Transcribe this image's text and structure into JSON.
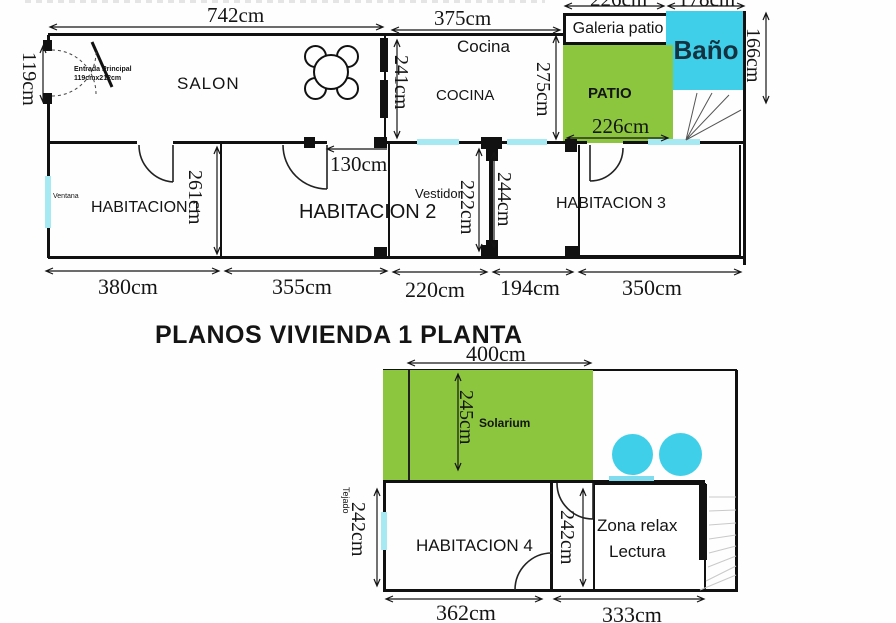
{
  "title": "PLANOS VIVIENDA 1 PLANTA",
  "colors": {
    "green": "#8CC63E",
    "cyan": "#3FCFE9",
    "window": "#A6E9F2",
    "wall": "#111111"
  },
  "upper": {
    "rooms": {
      "salon": "SALON",
      "cocina_small": "Cocina",
      "cocina": "COCINA",
      "galeria": "Galeria patio",
      "bano": "Baño",
      "patio": "PATIO",
      "hab1": "HABITACION 1",
      "hab2": "HABITACION 2",
      "hab3": "HABITACION 3",
      "vestidor": "Vestidor"
    },
    "notes": {
      "entrada1": "Entrada Principal",
      "entrada2": "119cmx212cm",
      "ventana": "Ventana"
    },
    "dims": {
      "salon_w": "742cm",
      "cocina_w": "375cm",
      "galeria_w": "226cm",
      "bano_w": "178cm",
      "entrada_h": "119cm",
      "salon_wall": "241cm",
      "cocina_h": "275cm",
      "bano_h": "166cm",
      "patio_w": "226cm",
      "door_w": "130cm",
      "hab1_h": "261cm",
      "vestidor_h": "222cm",
      "hab3_h": "244cm",
      "hab1_w": "380cm",
      "hab2_w": "355cm",
      "vestidor_w": "220cm",
      "pasillo_w": "194cm",
      "hab3_w": "350cm"
    }
  },
  "lower": {
    "rooms": {
      "solarium": "Solarium",
      "hab4": "HABITACION 4",
      "zona1": "Zona relax",
      "zona2": "Lectura"
    },
    "notes": {
      "tejado": "Tejado"
    },
    "dims": {
      "solarium_w": "400cm",
      "solarium_h": "245cm",
      "hab4_h": "242cm",
      "zona_h": "242cm",
      "hab4_w": "362cm",
      "zona_w": "333cm"
    }
  }
}
